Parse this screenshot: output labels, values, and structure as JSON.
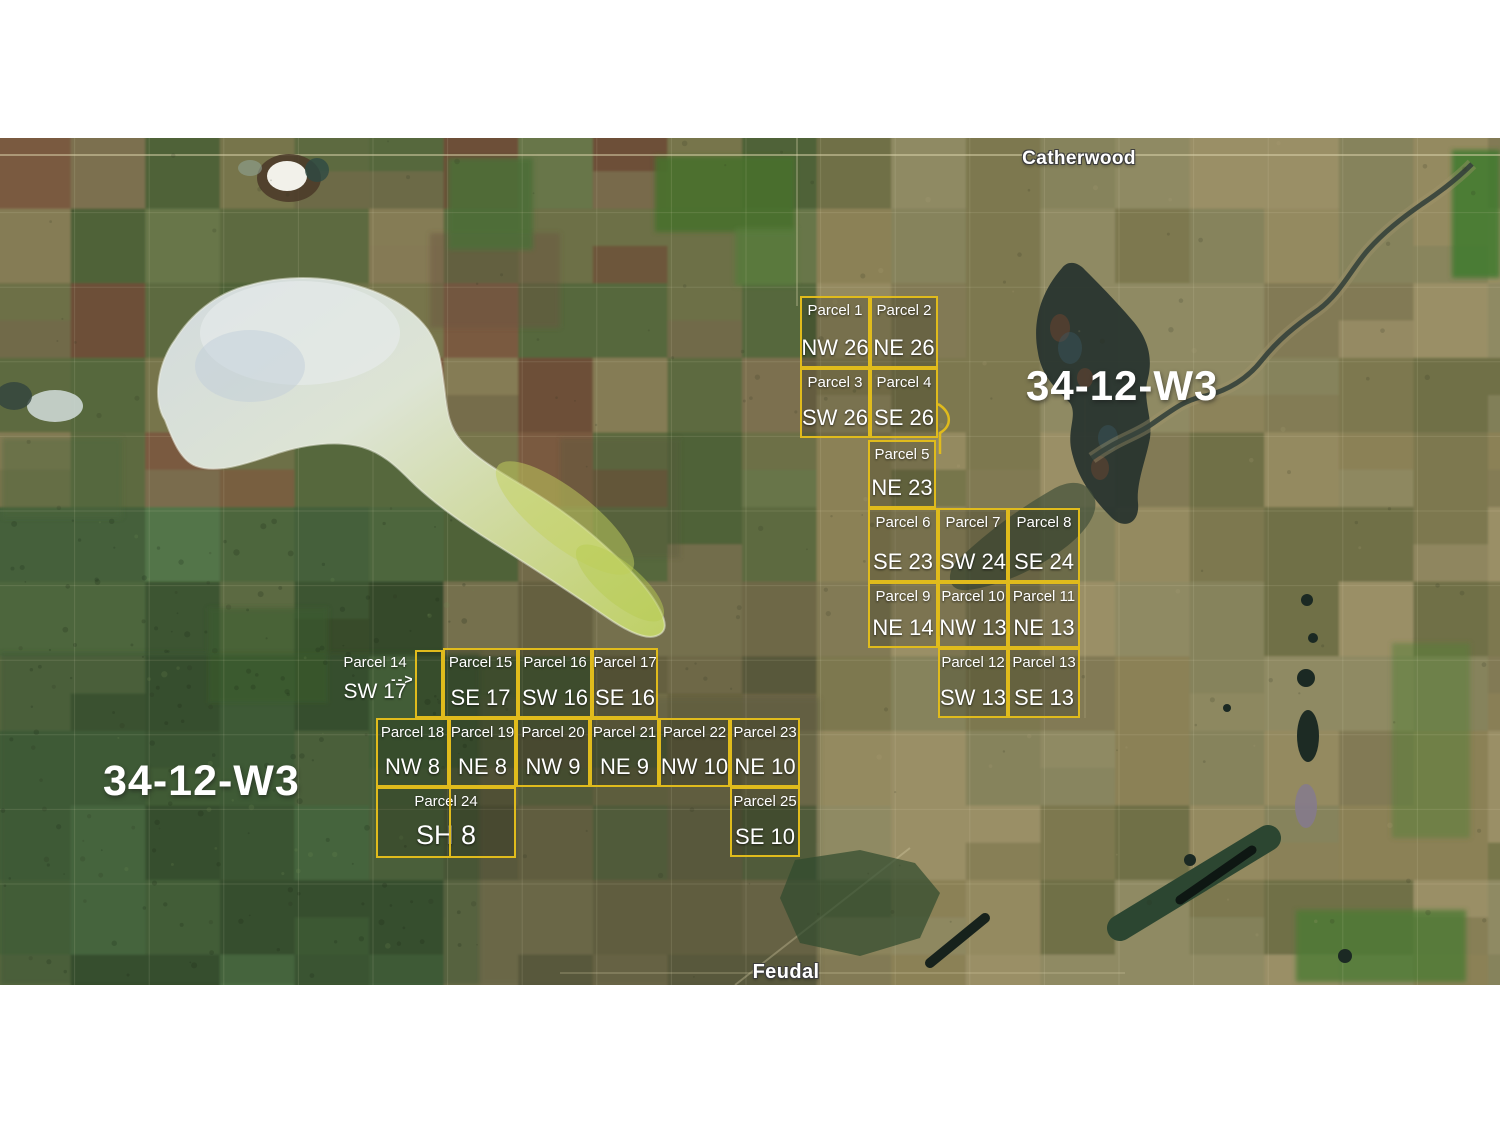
{
  "page": {
    "background": "#ffffff"
  },
  "map": {
    "top": 138,
    "height": 847,
    "width": 1500,
    "towns": [
      {
        "name": "Catherwood",
        "x": 1079,
        "y": 148
      },
      {
        "name": "Feudal",
        "x": 786,
        "y": 961
      }
    ],
    "region_labels": [
      {
        "text": "34-12-W3",
        "x": 1026,
        "y": 362
      },
      {
        "text": "34-12-W3",
        "x": 103,
        "y": 757
      }
    ]
  },
  "overlay": {
    "line_color": "#e0bb1c",
    "box_fill": "rgba(20,24,10,0.22)",
    "label_color": "#ffffff"
  },
  "parcels": [
    {
      "id": 1,
      "name": "Parcel 1",
      "quarter": "NW 26",
      "x": 800,
      "y": 296,
      "w": 70,
      "h": 72
    },
    {
      "id": 2,
      "name": "Parcel 2",
      "quarter": "NE 26",
      "x": 870,
      "y": 296,
      "w": 68,
      "h": 72
    },
    {
      "id": 3,
      "name": "Parcel 3",
      "quarter": "SW 26",
      "x": 800,
      "y": 368,
      "w": 70,
      "h": 70
    },
    {
      "id": 4,
      "name": "Parcel 4",
      "quarter": "SE 26",
      "x": 870,
      "y": 368,
      "w": 68,
      "h": 70
    },
    {
      "id": 5,
      "name": "Parcel 5",
      "quarter": "NE 23",
      "x": 868,
      "y": 440,
      "w": 68,
      "h": 68
    },
    {
      "id": 6,
      "name": "Parcel 6",
      "quarter": "SE 23",
      "x": 868,
      "y": 508,
      "w": 70,
      "h": 74
    },
    {
      "id": 7,
      "name": "Parcel 7",
      "quarter": "SW 24",
      "x": 938,
      "y": 508,
      "w": 70,
      "h": 74
    },
    {
      "id": 8,
      "name": "Parcel 8",
      "quarter": "SE 24",
      "x": 1008,
      "y": 508,
      "w": 72,
      "h": 74
    },
    {
      "id": 9,
      "name": "Parcel 9",
      "quarter": "NE 14",
      "x": 868,
      "y": 582,
      "w": 70,
      "h": 66
    },
    {
      "id": 10,
      "name": "Parcel 10",
      "quarter": "NW 13",
      "x": 938,
      "y": 582,
      "w": 70,
      "h": 66
    },
    {
      "id": 11,
      "name": "Parcel 11",
      "quarter": "NE 13",
      "x": 1008,
      "y": 582,
      "w": 72,
      "h": 66
    },
    {
      "id": 12,
      "name": "Parcel 12",
      "quarter": "SW 13",
      "x": 938,
      "y": 648,
      "w": 70,
      "h": 70
    },
    {
      "id": 13,
      "name": "Parcel 13",
      "quarter": "SE 13",
      "x": 1008,
      "y": 648,
      "w": 72,
      "h": 70
    },
    {
      "id": 14,
      "name": "Parcel 14",
      "quarter": "SW 17",
      "x": 415,
      "y": 650,
      "w": 28,
      "h": 68,
      "label_outside": {
        "x": 336,
        "y": 654,
        "w": 78
      },
      "arrow": {
        "x": 391,
        "y": 671,
        "glyph": "-->"
      }
    },
    {
      "id": 15,
      "name": "Parcel 15",
      "quarter": "SE 17",
      "x": 443,
      "y": 648,
      "w": 75,
      "h": 70
    },
    {
      "id": 16,
      "name": "Parcel 16",
      "quarter": "SW 16",
      "x": 518,
      "y": 648,
      "w": 74,
      "h": 70
    },
    {
      "id": 17,
      "name": "Parcel 17",
      "quarter": "SE 16",
      "x": 592,
      "y": 648,
      "w": 66,
      "h": 70
    },
    {
      "id": 18,
      "name": "Parcel 18",
      "quarter": "NW 8",
      "x": 376,
      "y": 718,
      "w": 73,
      "h": 69
    },
    {
      "id": 19,
      "name": "Parcel 19",
      "quarter": "NE 8",
      "x": 449,
      "y": 718,
      "w": 67,
      "h": 69
    },
    {
      "id": 20,
      "name": "Parcel 20",
      "quarter": "NW 9",
      "x": 516,
      "y": 718,
      "w": 74,
      "h": 69
    },
    {
      "id": 21,
      "name": "Parcel 21",
      "quarter": "NE 9",
      "x": 590,
      "y": 718,
      "w": 69,
      "h": 69
    },
    {
      "id": 22,
      "name": "Parcel 22",
      "quarter": "NW 10",
      "x": 659,
      "y": 718,
      "w": 71,
      "h": 69
    },
    {
      "id": 23,
      "name": "Parcel 23",
      "quarter": "NE 10",
      "x": 730,
      "y": 718,
      "w": 70,
      "h": 69
    },
    {
      "id": 24,
      "name": "Parcel 24",
      "quarter": "SH 8",
      "x": 376,
      "y": 787,
      "w": 140,
      "h": 71,
      "divider_x": 449,
      "quarter_size": 27
    },
    {
      "id": 25,
      "name": "Parcel 25",
      "quarter": "SE 10",
      "x": 730,
      "y": 787,
      "w": 70,
      "h": 70
    }
  ]
}
